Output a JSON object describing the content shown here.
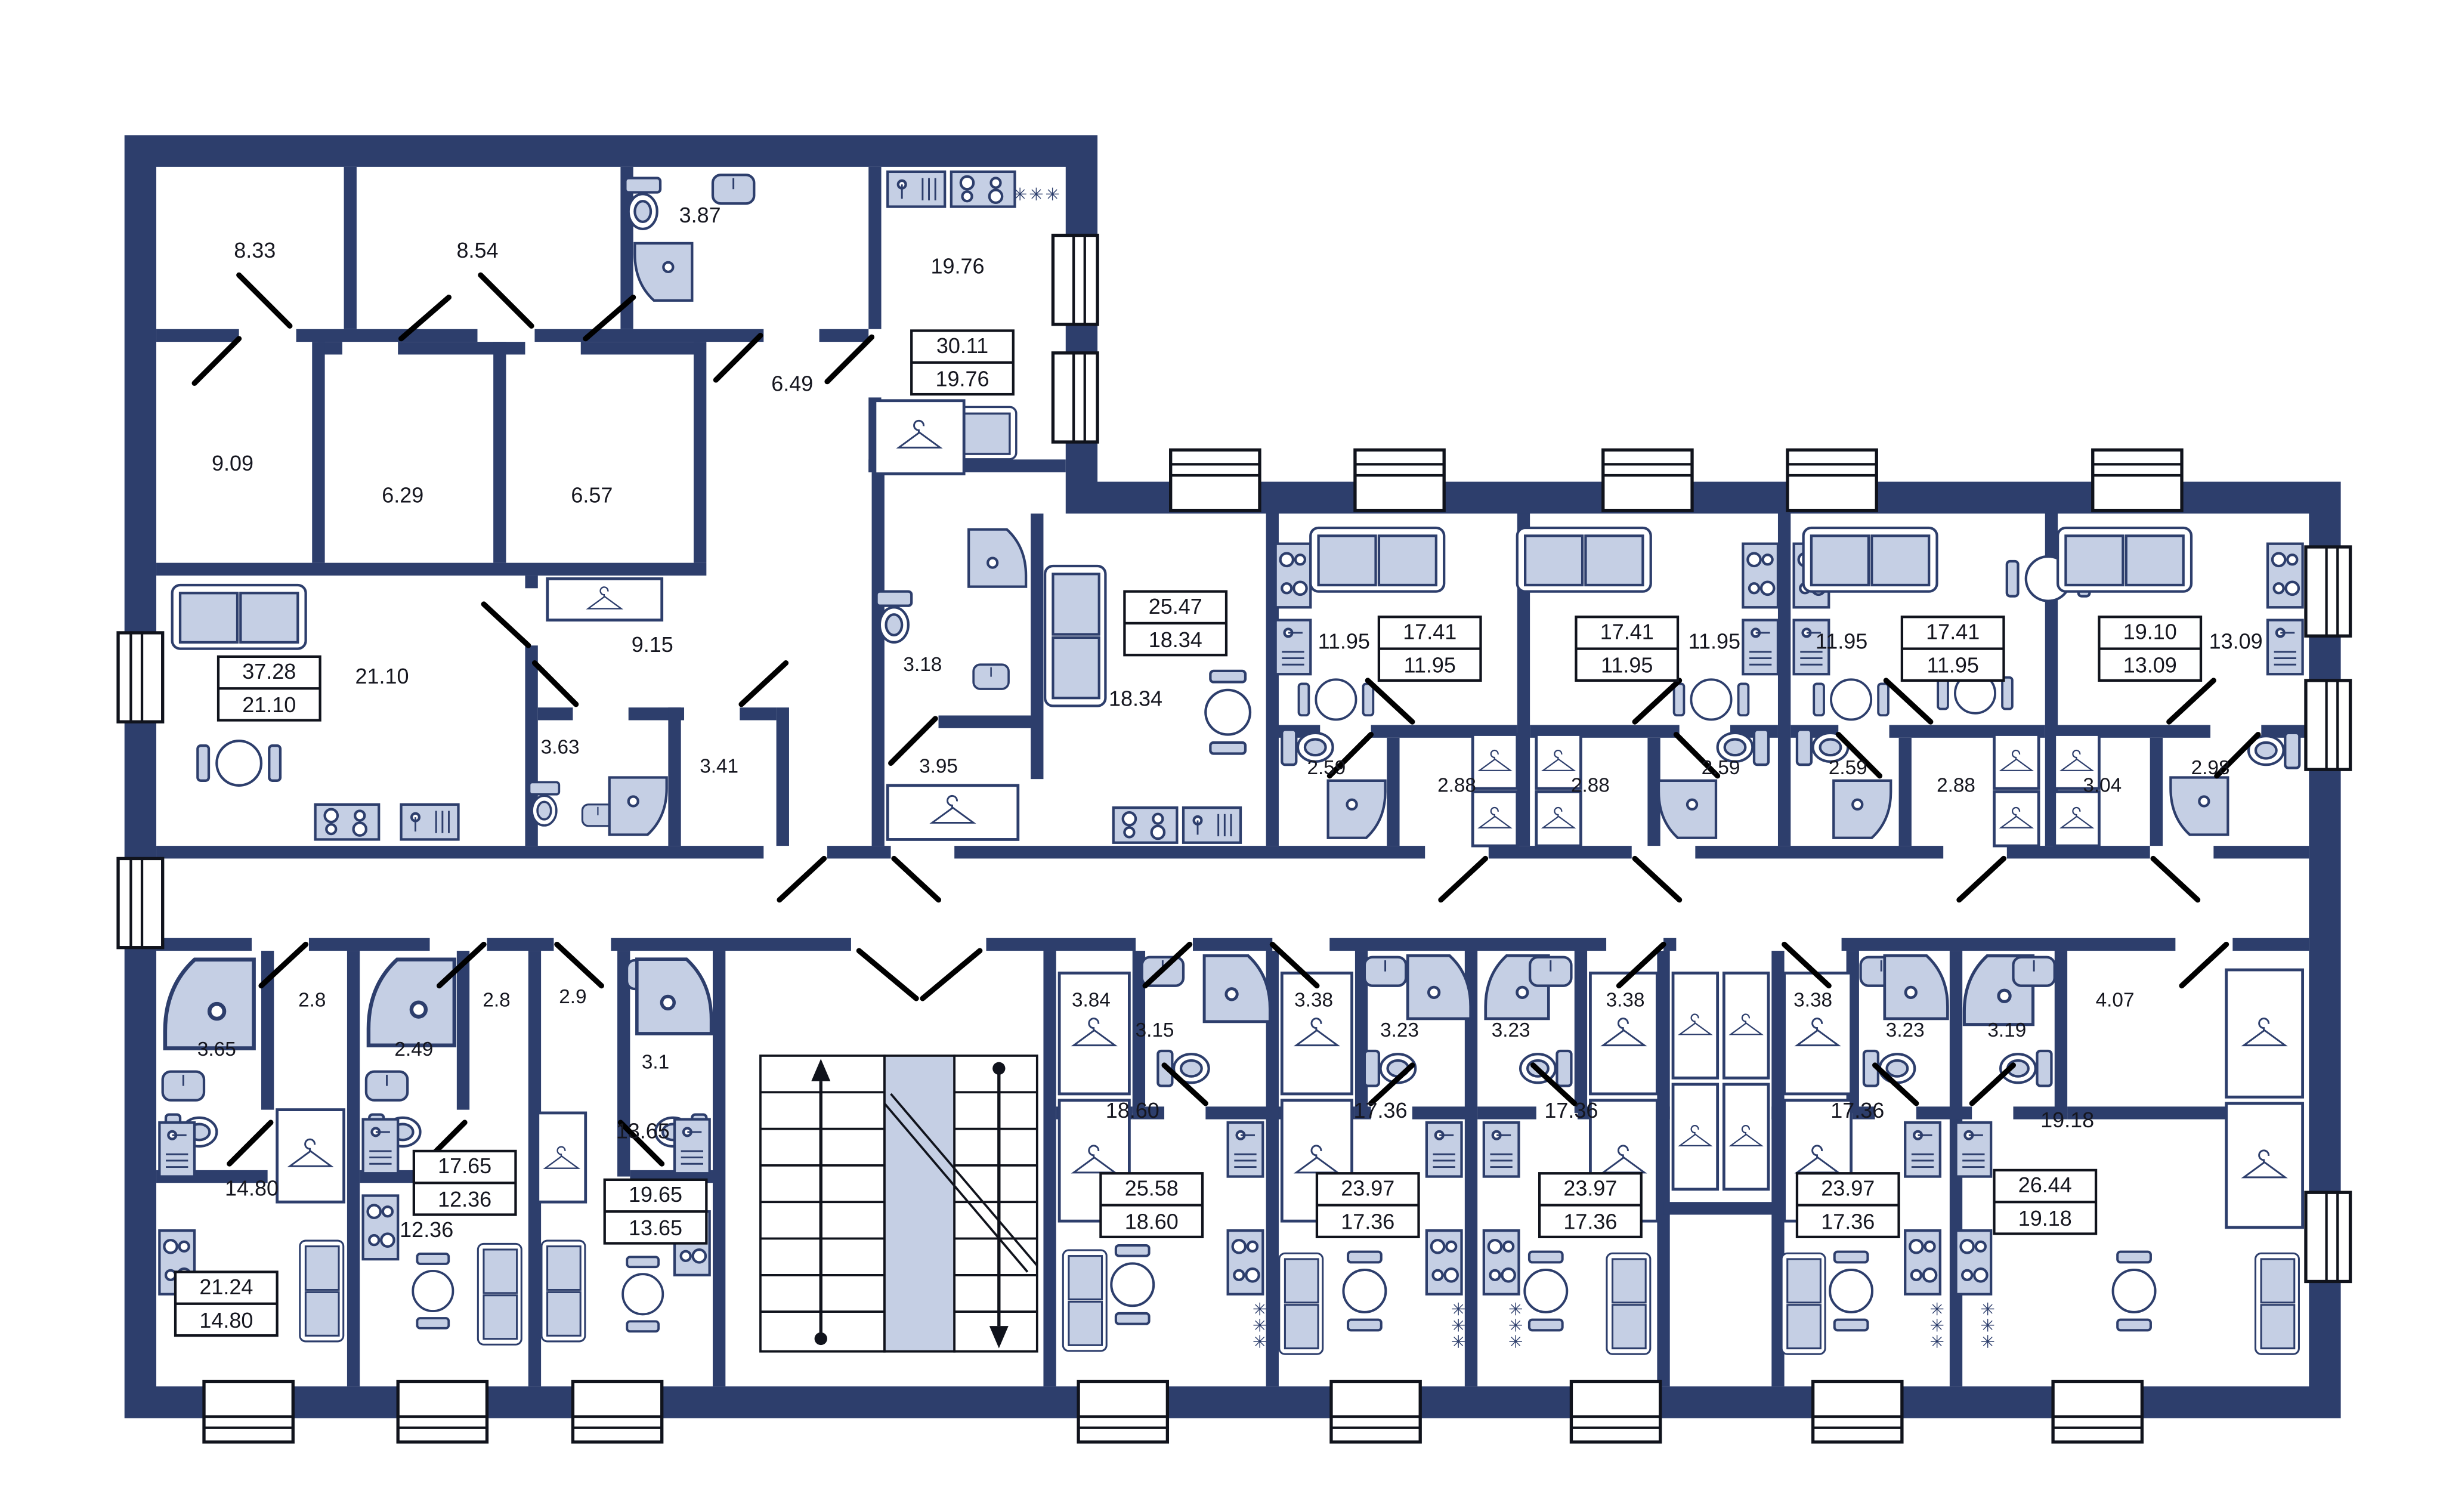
{
  "plan_title": "Apartment floor plan",
  "colors": {
    "wall": "#2d3e6c",
    "furniture_fill": "#c5cfe4",
    "background": "#ffffff",
    "door": "#000000",
    "label_text": "#15161f"
  },
  "icons": {
    "fridge_glyph": "✳✳✳"
  },
  "room_labels": [
    {
      "id": "wing-room-1",
      "area": "8.33"
    },
    {
      "id": "wing-room-2",
      "area": "8.54"
    },
    {
      "id": "wing-bath",
      "area": "3.87"
    },
    {
      "id": "wing-kitchen-living",
      "area": "19.76"
    },
    {
      "id": "wing-hall",
      "area": "6.49"
    },
    {
      "id": "wing-room-3",
      "area": "9.09"
    },
    {
      "id": "wing-room-4",
      "area": "6.29"
    },
    {
      "id": "wing-room-5",
      "area": "6.57"
    },
    {
      "id": "unit37-living",
      "area": "21.10"
    },
    {
      "id": "unit37-corridor",
      "area": "9.15"
    },
    {
      "id": "unit37-bath",
      "area": "3.63"
    },
    {
      "id": "unit37-storage",
      "area": "3.41"
    },
    {
      "id": "unit25-living",
      "area": "18.34"
    },
    {
      "id": "unit25-wc",
      "area": "3.18"
    },
    {
      "id": "unit25-hall",
      "area": "3.95"
    },
    {
      "id": "studio1-living",
      "area": "11.95"
    },
    {
      "id": "studio1-bath",
      "area": "2.59"
    },
    {
      "id": "studio1-hall",
      "area": "2.88"
    },
    {
      "id": "studio2-living",
      "area": "11.95"
    },
    {
      "id": "studio2-hall",
      "area": "2.88"
    },
    {
      "id": "studio2-bath",
      "area": "2.59"
    },
    {
      "id": "studio3-living",
      "area": "11.95"
    },
    {
      "id": "studio3-bath",
      "area": "2.59"
    },
    {
      "id": "studio3-hall",
      "area": "2.88"
    },
    {
      "id": "studio4-living",
      "area": "13.09"
    },
    {
      "id": "studio4-hall",
      "area": "3.04"
    },
    {
      "id": "studio4-bath",
      "area": "2.98"
    },
    {
      "id": "unitL1-bath",
      "area": "3.65"
    },
    {
      "id": "unitL1-hall",
      "area": "2.8"
    },
    {
      "id": "unitL1-living",
      "area": "14.80"
    },
    {
      "id": "unitL2-bath",
      "area": "2.49"
    },
    {
      "id": "unitL2-hall",
      "area": "2.8"
    },
    {
      "id": "unitL2-living",
      "area": "12.36"
    },
    {
      "id": "unitL3-hall",
      "area": "2.9"
    },
    {
      "id": "unitL3-bath",
      "area": "3.1"
    },
    {
      "id": "unitL3-living",
      "area": "13.65"
    },
    {
      "id": "unitM1-hall",
      "area": "3.84"
    },
    {
      "id": "unitM1-bath",
      "area": "3.15"
    },
    {
      "id": "unitM1-living",
      "area": "18.60"
    },
    {
      "id": "unitM2-hall",
      "area": "3.38"
    },
    {
      "id": "unitM2-bath",
      "area": "3.23"
    },
    {
      "id": "unitM2-living",
      "area": "17.36"
    },
    {
      "id": "unitM3-bath",
      "area": "3.23"
    },
    {
      "id": "unitM3-hall",
      "area": "3.38"
    },
    {
      "id": "unitM3-living",
      "area": "17.36"
    },
    {
      "id": "unitM4-hall",
      "area": "3.38"
    },
    {
      "id": "unitM4-bath",
      "area": "3.23"
    },
    {
      "id": "unitM4-living",
      "area": "17.36"
    },
    {
      "id": "unitM5-bath",
      "area": "3.19"
    },
    {
      "id": "unitM5-hall",
      "area": "4.07"
    },
    {
      "id": "unitM5-living",
      "area": "19.18"
    }
  ],
  "unit_summaries": [
    {
      "id": "unit-30-11",
      "total": "30.11",
      "living": "19.76"
    },
    {
      "id": "unit-37-28",
      "total": "37.28",
      "living": "21.10"
    },
    {
      "id": "unit-25-47",
      "total": "25.47",
      "living": "18.34"
    },
    {
      "id": "studio-1",
      "total": "17.41",
      "living": "11.95"
    },
    {
      "id": "studio-2",
      "total": "17.41",
      "living": "11.95"
    },
    {
      "id": "studio-3",
      "total": "17.41",
      "living": "11.95"
    },
    {
      "id": "studio-4",
      "total": "19.10",
      "living": "13.09"
    },
    {
      "id": "unit-21-24",
      "total": "21.24",
      "living": "14.80"
    },
    {
      "id": "unit-17-65",
      "total": "17.65",
      "living": "12.36"
    },
    {
      "id": "unit-19-65",
      "total": "19.65",
      "living": "13.65"
    },
    {
      "id": "unit-25-58",
      "total": "25.58",
      "living": "18.60"
    },
    {
      "id": "unit-23-97-a",
      "total": "23.97",
      "living": "17.36"
    },
    {
      "id": "unit-23-97-b",
      "total": "23.97",
      "living": "17.36"
    },
    {
      "id": "unit-23-97-c",
      "total": "23.97",
      "living": "17.36"
    },
    {
      "id": "unit-26-44",
      "total": "26.44",
      "living": "19.18"
    }
  ]
}
